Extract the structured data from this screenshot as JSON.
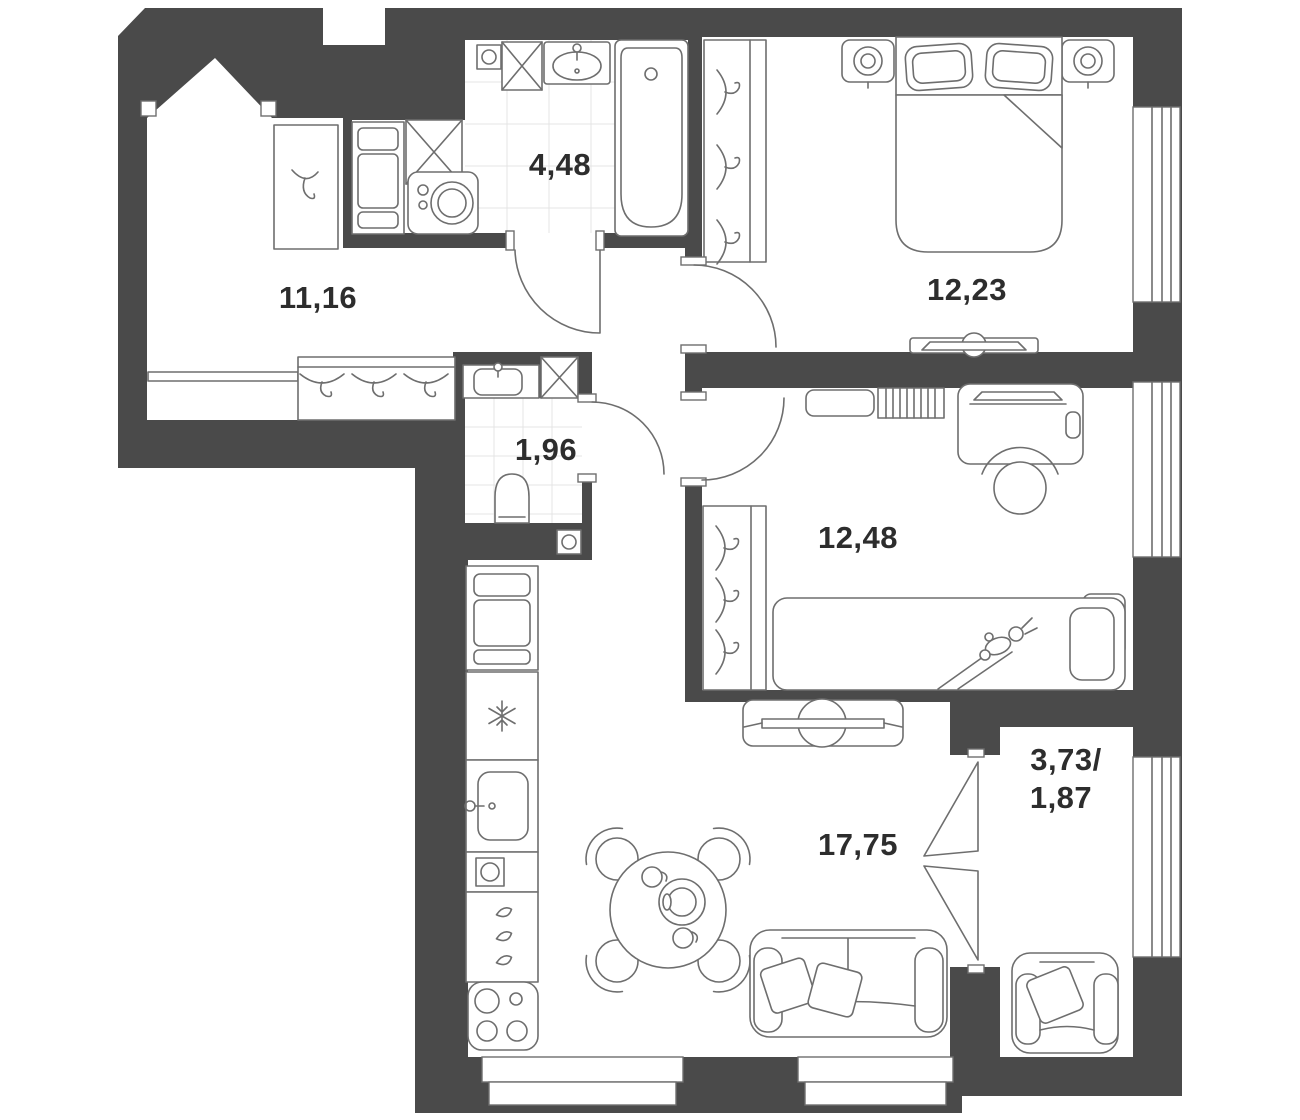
{
  "floor_plan": {
    "type": "apartment-floor-plan",
    "colors": {
      "wall": "#4a4a4a",
      "floor": "#ffffff",
      "furniture_line": "#6e6e6e",
      "label": "#2d2d2d",
      "tile_line": "#e4e4e4"
    },
    "rooms": [
      {
        "id": "bathroom",
        "area": "4,48"
      },
      {
        "id": "hallway",
        "area": "11,16"
      },
      {
        "id": "wc",
        "area": "1,96"
      },
      {
        "id": "bedroom",
        "area": "12,23"
      },
      {
        "id": "kids-room",
        "area": "12,48"
      },
      {
        "id": "kitchen-living-room",
        "area": "17,75"
      },
      {
        "id": "balcony",
        "area_line1": "3,73/",
        "area_line2": "1,87"
      }
    ]
  }
}
